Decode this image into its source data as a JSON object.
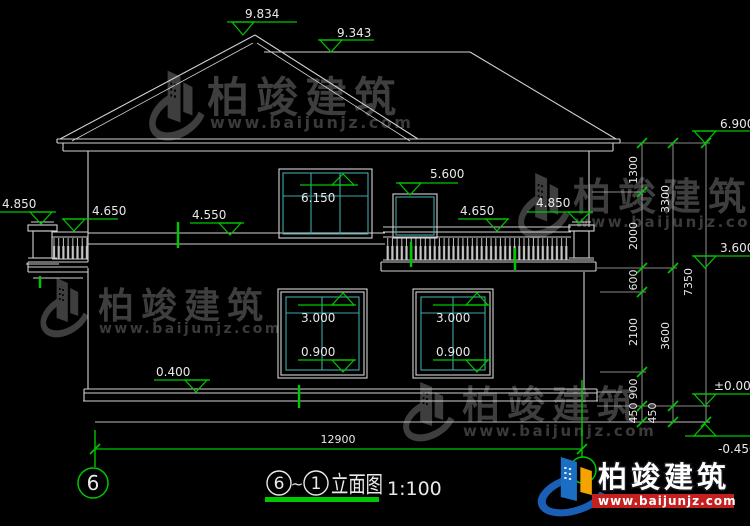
{
  "colors": {
    "background": "#000000",
    "line_white": "#d2d2d2",
    "marker_green": "#00c800",
    "window_teal": "#3fa8a8",
    "logo_blue": "#1a6fc4",
    "logo_orange": "#f5a300",
    "logo_red_bar": "#c42020",
    "watermark_gray": "#3e3e3e"
  },
  "watermark": {
    "name": "柏竣建筑",
    "url": "www.baijunjz.com"
  },
  "markers": {
    "ridge_main": "9.834",
    "ridge_secondary": "9.343",
    "eave": "6.900",
    "win2f_top": "6.150",
    "win2f_small_top": "5.600",
    "post_left": "4.850",
    "rail_left": "4.650",
    "belt": "4.550",
    "rail_right": "4.650",
    "post_right": "4.850",
    "floor2": "3.600",
    "winA_top": "3.000",
    "winA_sill": "0.900",
    "winB_top": "3.000",
    "winB_sill": "0.900",
    "plinth": "0.400",
    "zero": "±0.000",
    "ground": "-0.450"
  },
  "dims": {
    "inner": [
      "1300",
      "2000",
      "600",
      "2100",
      "900",
      "450"
    ],
    "middle": [
      "3300",
      "3600",
      "450"
    ],
    "outer": "7350",
    "bottom": "12900"
  },
  "axes": {
    "left_bubble": "6"
  },
  "title": {
    "bubble_left": "6",
    "tilde": "~",
    "bubble_right": "1",
    "label": "立面图",
    "scale": "1:100"
  }
}
